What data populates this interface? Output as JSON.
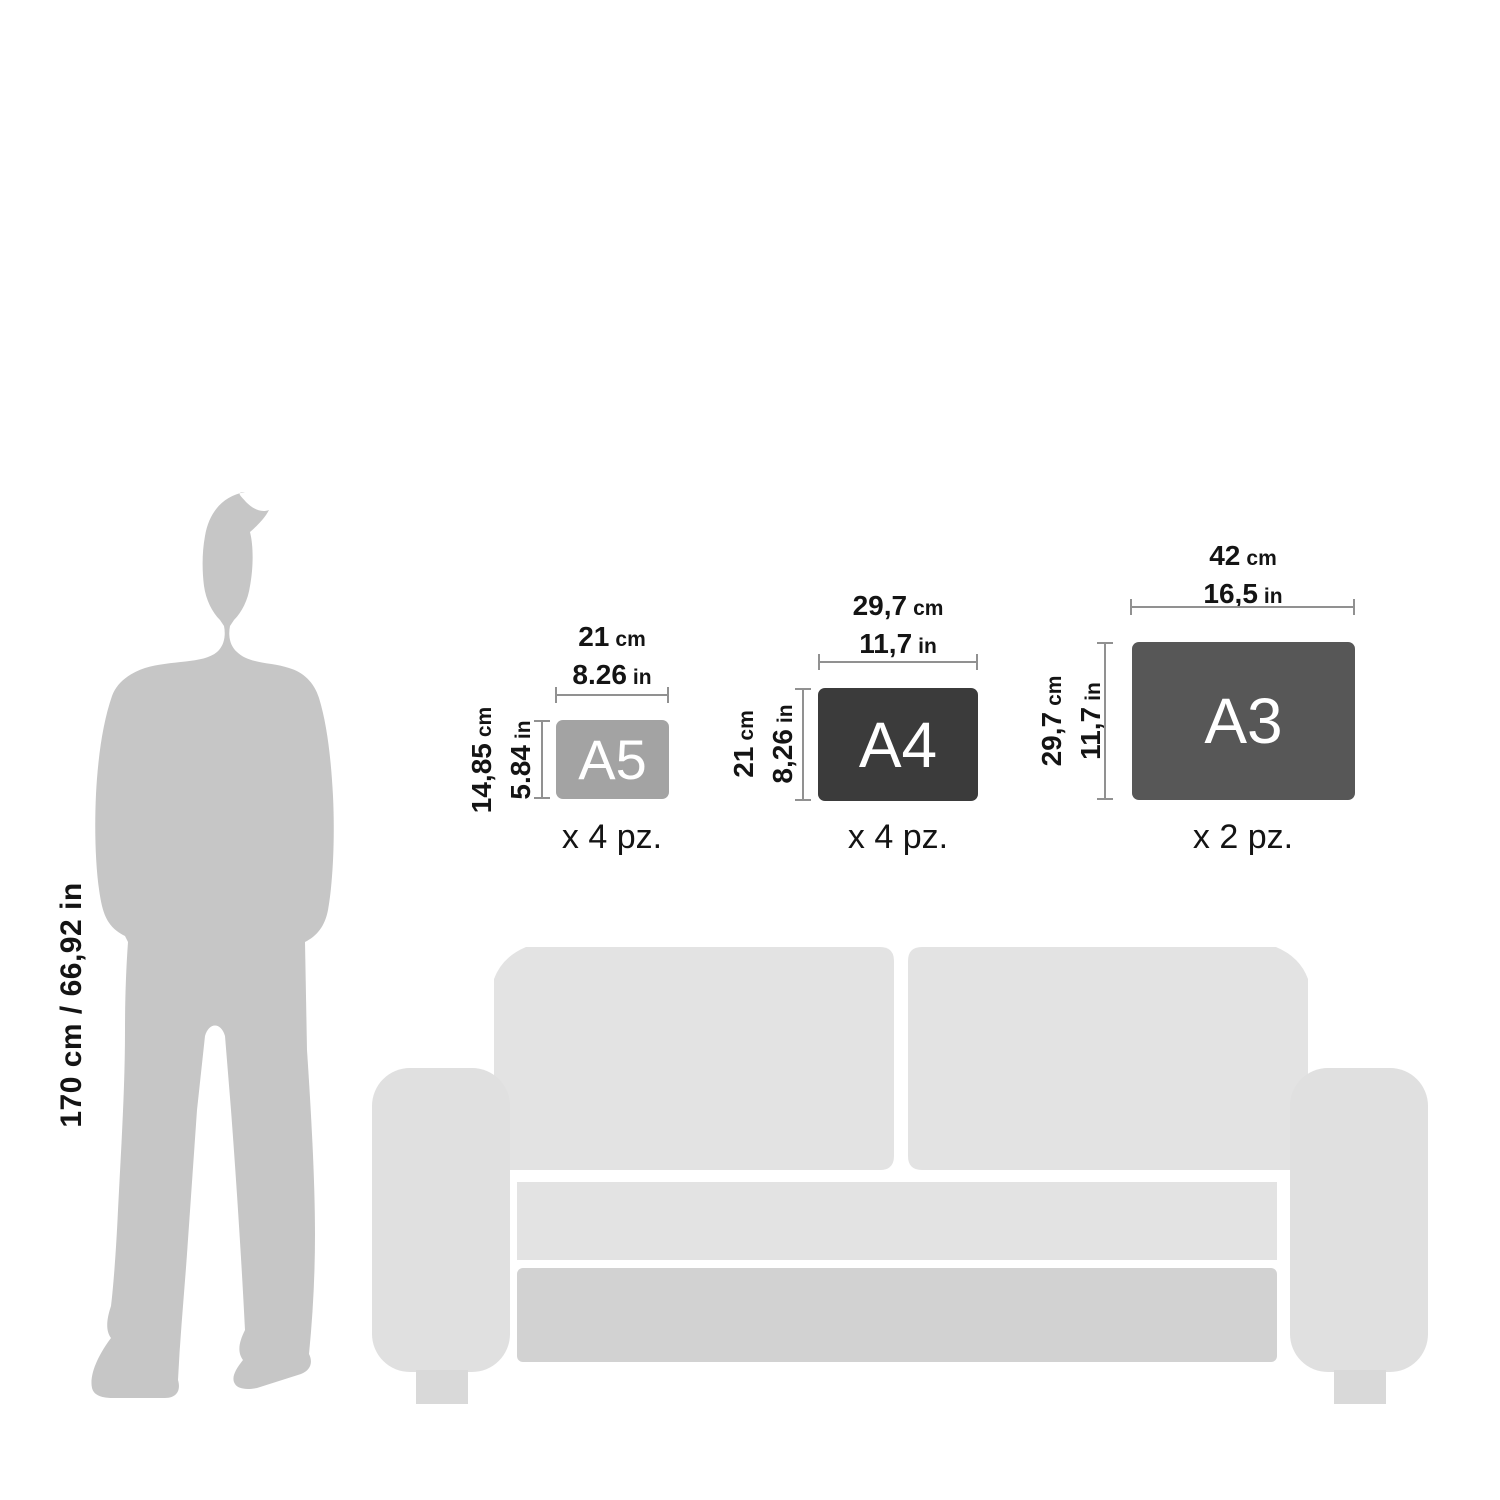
{
  "person": {
    "height_label": "170 cm / 66,92 in"
  },
  "papers": [
    {
      "name": "A5",
      "width_value": "21",
      "width_unit": "cm",
      "width_alt_value": "8.26",
      "width_alt_unit": "in",
      "height_value": "14,85",
      "height_unit": "cm",
      "height_alt_value": "5.84",
      "height_alt_unit": "in",
      "quantity": "x 4 pz.",
      "fill": "#a3a3a3"
    },
    {
      "name": "A4",
      "width_value": "29,7",
      "width_unit": "cm",
      "width_alt_value": "11,7",
      "width_alt_unit": "in",
      "height_value": "21",
      "height_unit": "cm",
      "height_alt_value": "8,26",
      "height_alt_unit": "in",
      "quantity": "x 4 pz.",
      "fill": "#3b3b3b"
    },
    {
      "name": "A3",
      "width_value": "42",
      "width_unit": "cm",
      "width_alt_value": "16,5",
      "width_alt_unit": "in",
      "height_value": "29,7",
      "height_unit": "cm",
      "height_alt_value": "11,7",
      "height_alt_unit": "in",
      "quantity": "x 2 pz.",
      "fill": "#575757"
    }
  ],
  "colors": {
    "person_silhouette": "#c6c6c6",
    "sofa_cushion": "#e3e3e3",
    "sofa_base": "#d2d2d2",
    "dimension_line": "#919191",
    "text": "#141414",
    "paper_label": "#ffffff"
  }
}
